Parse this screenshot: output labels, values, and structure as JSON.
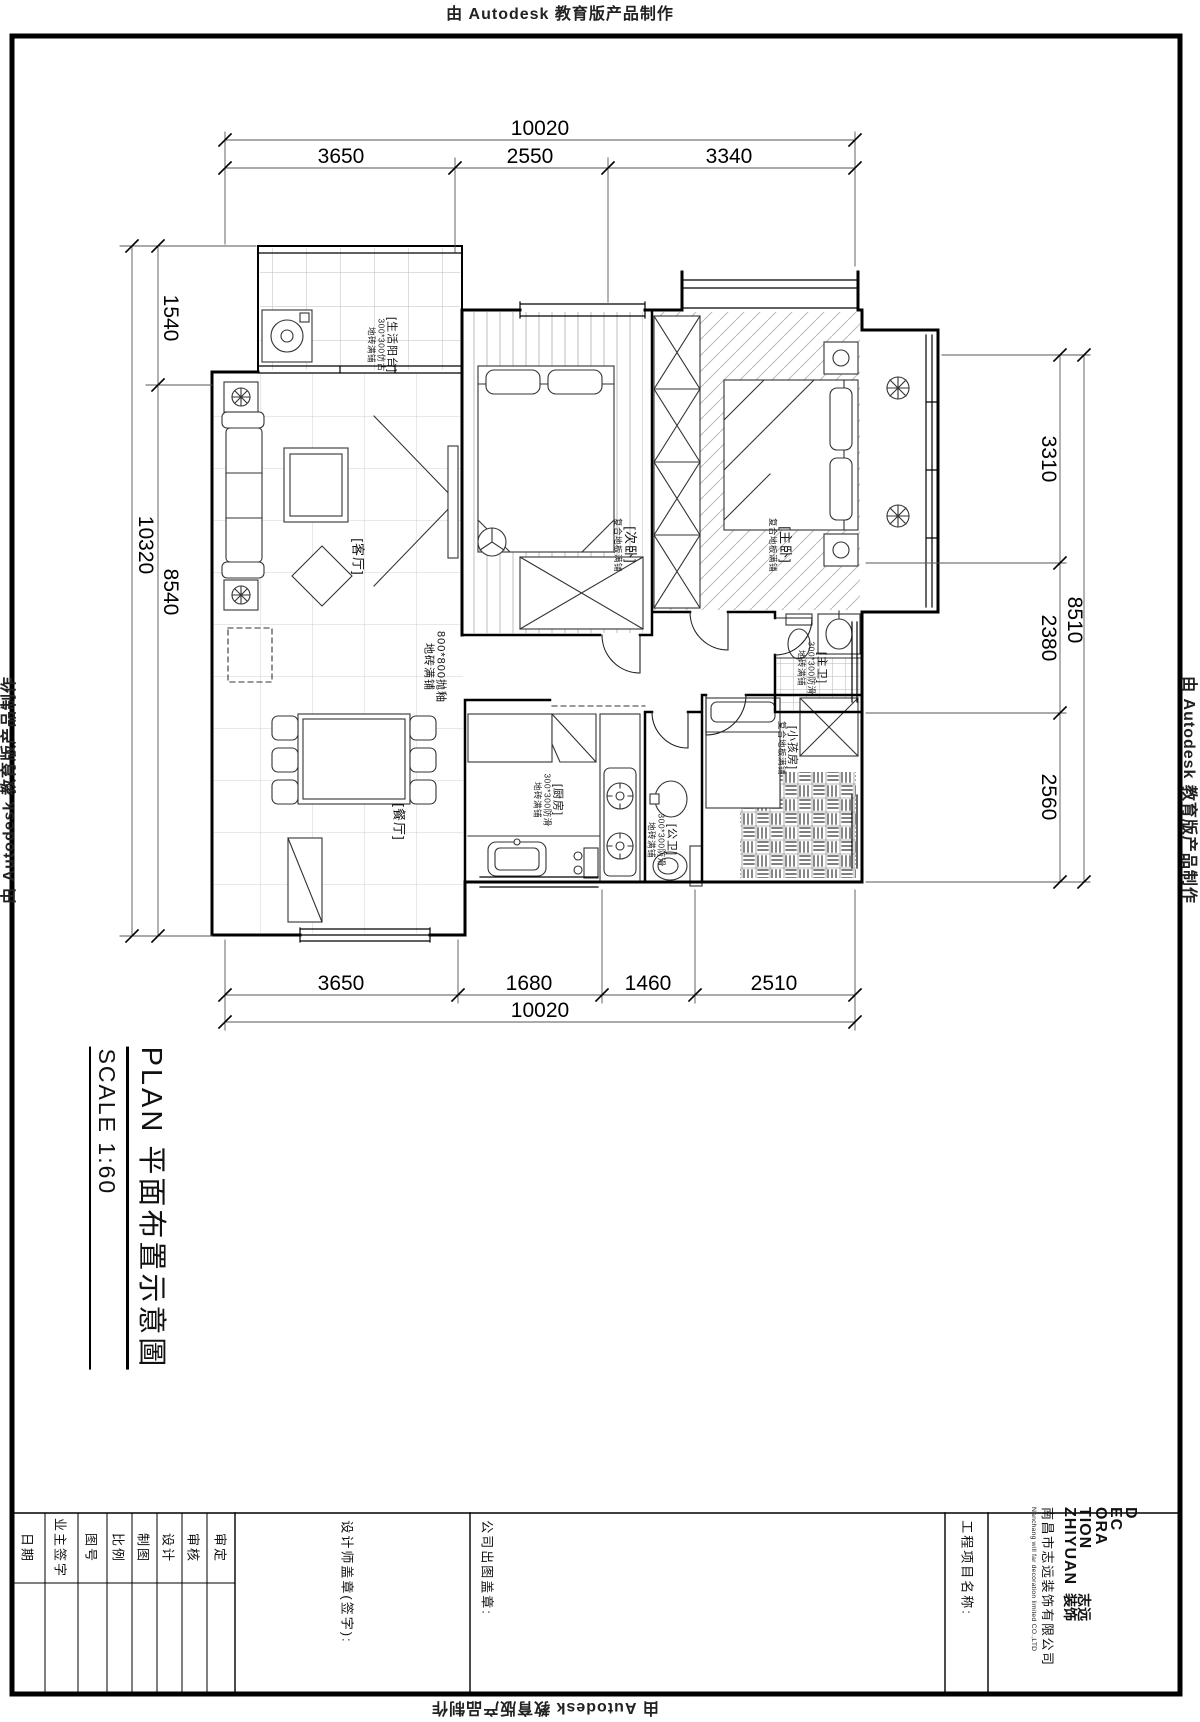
{
  "watermark": {
    "text": "由 Autodesk 教育版产品制作"
  },
  "dimensions": {
    "top": {
      "overall": "10020",
      "segments": [
        "3650",
        "2550",
        "3340"
      ]
    },
    "bottom": {
      "overall": "10020",
      "segments": [
        "3650",
        "1680",
        "1460",
        "2510"
      ]
    },
    "left": {
      "outer_total": "10320",
      "inner_total": "8540",
      "segment": "1540"
    },
    "right": {
      "outer_total": "8510",
      "segments": [
        "3310",
        "2380",
        "2560"
      ]
    }
  },
  "rooms": {
    "balcony": {
      "name": "[生活阳台]",
      "finish1": "300*300仿古",
      "finish2": "地砖满铺"
    },
    "living": {
      "name": "[客厅]"
    },
    "floor_note": {
      "line1": "800*800抛釉",
      "line2": "地砖满铺"
    },
    "bedroom2": {
      "name": "[次卧]",
      "finish1": "复合地板满铺"
    },
    "master": {
      "name": "[主卧]",
      "finish1": "复合地板满铺"
    },
    "master_bath": {
      "name": "[主卫]",
      "finish1": "300*300防滑",
      "finish2": "地砖满铺"
    },
    "kids": {
      "name": "[小孩房]",
      "finish1": "复合地板满铺"
    },
    "dining": {
      "name": "[餐厅]"
    },
    "kitchen": {
      "name": "[厨房]",
      "finish1": "300*300防滑",
      "finish2": "地砖满铺"
    },
    "bath2": {
      "name": "[公卫]",
      "finish1": "300*300防滑",
      "finish2": "地砖满铺"
    }
  },
  "title": {
    "plan": "PLAN  平面布置示意圖",
    "scale": "SCALE  1:60"
  },
  "tit8leblock_note": "",
  "titleblock": {
    "fields": [
      "日期",
      "业主签字",
      "图号",
      "比例",
      "制图",
      "设计",
      "审核",
      "审定"
    ],
    "designer_stamp": "设计师盖章(签字):",
    "company_stamp": "公司出图盖章:",
    "project_label": "工程项目名称:",
    "company_cn": "南昌市志远装饰有限公司",
    "company_en": "Nanchang will far decoration limited CO.,LTD",
    "logo": {
      "l1": "D",
      "l2": "EC",
      "l3": "ORA",
      "l4": "TION",
      "l5": "ZHIYUAN",
      "cn1": "志远",
      "cn2": "装饰"
    }
  }
}
